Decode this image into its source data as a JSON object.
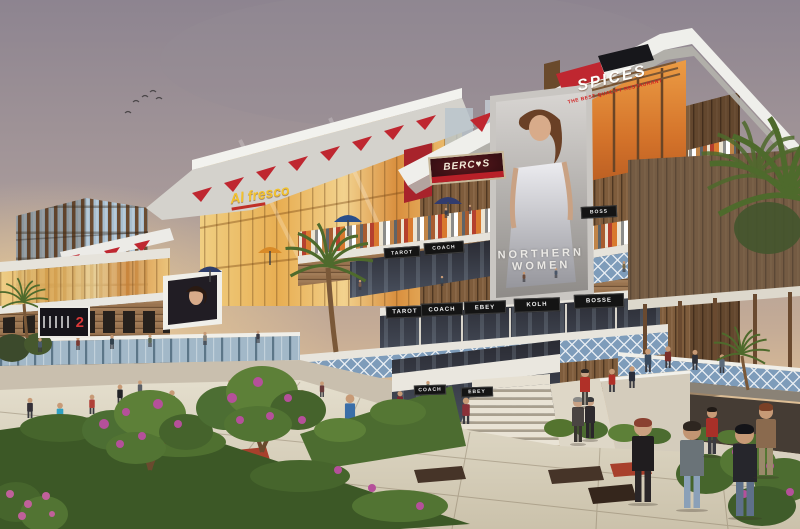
{
  "signs": {
    "spices": {
      "name": "SPICES",
      "tagline": "THE BEST QUALITY RESTAURANT"
    },
    "bercos": {
      "name": "BERC♥S"
    },
    "alfresco": {
      "name": "Al fresco"
    }
  },
  "billboards": {
    "fashion": {
      "line1": "NORTHERN",
      "line2": "WOMEN"
    },
    "left_panel_number": "2"
  },
  "stores": {
    "ground_row": [
      "TAROT",
      "COACH",
      "EBEY",
      "KOLH",
      "BOSSE"
    ],
    "upper_row": [
      "TAROT",
      "COACH"
    ],
    "top_row": [
      "BOSS"
    ],
    "lower_row": [
      "COACH",
      "EBEY"
    ]
  },
  "colors": {
    "accent_red": "#bf2730",
    "roof_white": "#efefeb",
    "wood_brown": "#9a7450",
    "lattice_blue": "#7e9cba",
    "sky_glow": "#f4d8a4",
    "foliage_green": "#4c6c30",
    "flower_magenta": "#b5509a"
  }
}
